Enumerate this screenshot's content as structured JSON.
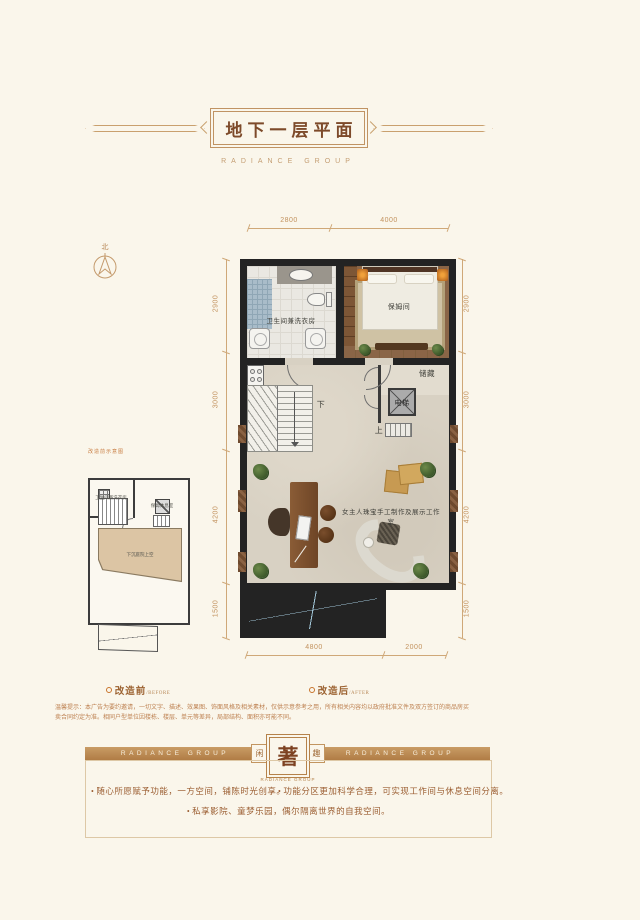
{
  "header": {
    "title": "地下一层平面",
    "subtitle": "RADIANCE GROUP"
  },
  "compass": {
    "north": "北"
  },
  "plan": {
    "rooms": {
      "bathroom": "卫生间兼洗衣房",
      "nanny": "保姆间",
      "storage": "储藏",
      "elevator": "电梯",
      "down": "下",
      "up": "上",
      "studio": "女主人珠宝手工制作及展示工作室"
    },
    "dims": {
      "top": [
        "2800",
        "4000"
      ],
      "bottom": [
        "4800",
        "2000"
      ],
      "left": [
        "2900",
        "3000",
        "4200",
        "1500"
      ],
      "right": [
        "2900",
        "3000",
        "4200",
        "1500"
      ]
    }
  },
  "before": {
    "caption": "改造前示意图",
    "rooms": {
      "bathroom": "卫生间兼洗衣房",
      "rest": "保姆休息室",
      "void": "下沉庭院上空"
    }
  },
  "captions": {
    "before": "改造前",
    "before_en": "/BEFORE",
    "after": "改造后",
    "after_en": "/AFTER"
  },
  "disclaimer": {
    "line1": "温馨提示：本广告为要约邀请，一切文字、描述、效果图、饰面风格及相关素材，仅供示意参考之用，所有相关内容均以政府批准文件及双方签订的商品房买",
    "line2": "卖合同约定为准。相同户型单位因楼栋、楼层、单元等差异，局部结构、面积亦可能不同。"
  },
  "banner": {
    "group_left": "RADIANCE GROUP",
    "group_right": "RADIANCE GROUP",
    "seal_left": "闲",
    "seal": "著",
    "seal_right": "趣",
    "seal_caption": "RADIANCE GROUP"
  },
  "features": {
    "bullet": "•",
    "item1": "随心所愿赋予功能，一方空间，铺陈时光创享。",
    "item2": "功能分区更加科学合理，可实现工作间与休息空间分离。",
    "item3": "私享影院、童梦乐园，偶尔隔离世界的自我空间。"
  }
}
